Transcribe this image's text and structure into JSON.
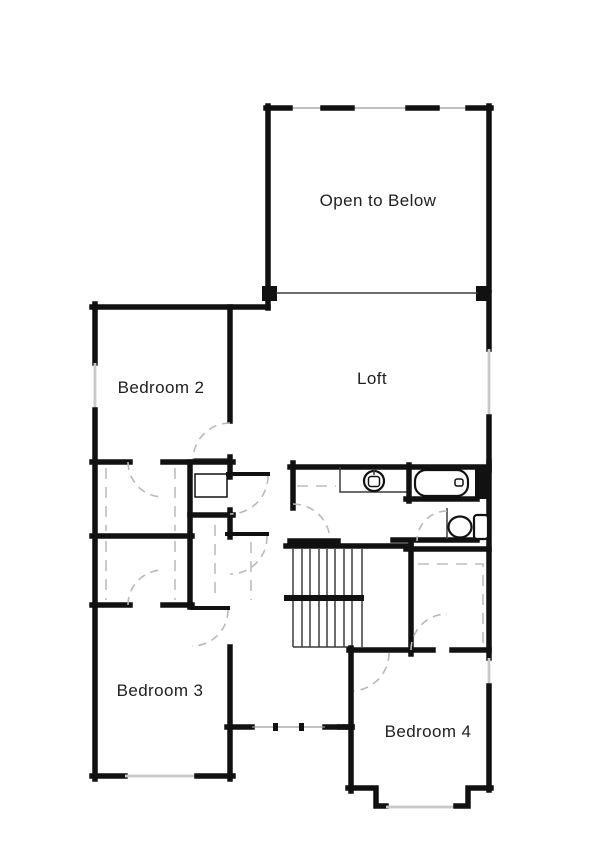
{
  "plan": {
    "type": "floor-plan",
    "floor": "second-floor",
    "background": "#ffffff"
  },
  "rooms": [
    {
      "id": "open-to-below",
      "label": "Open to Below"
    },
    {
      "id": "loft",
      "label": "Loft"
    },
    {
      "id": "bedroom-2",
      "label": "Bedroom 2"
    },
    {
      "id": "bedroom-3",
      "label": "Bedroom 3"
    },
    {
      "id": "bedroom-4",
      "label": "Bedroom 4"
    }
  ],
  "fixtures": [
    "bathtub-icon",
    "sink-icon",
    "toilet-icon",
    "staircase-icon",
    "linen-cabinet-icon"
  ],
  "colors": {
    "wall": "#111111",
    "window_line": "#c9c9c9",
    "door_swing": "#b9b9b9",
    "label_text": "#1f1f1f"
  }
}
